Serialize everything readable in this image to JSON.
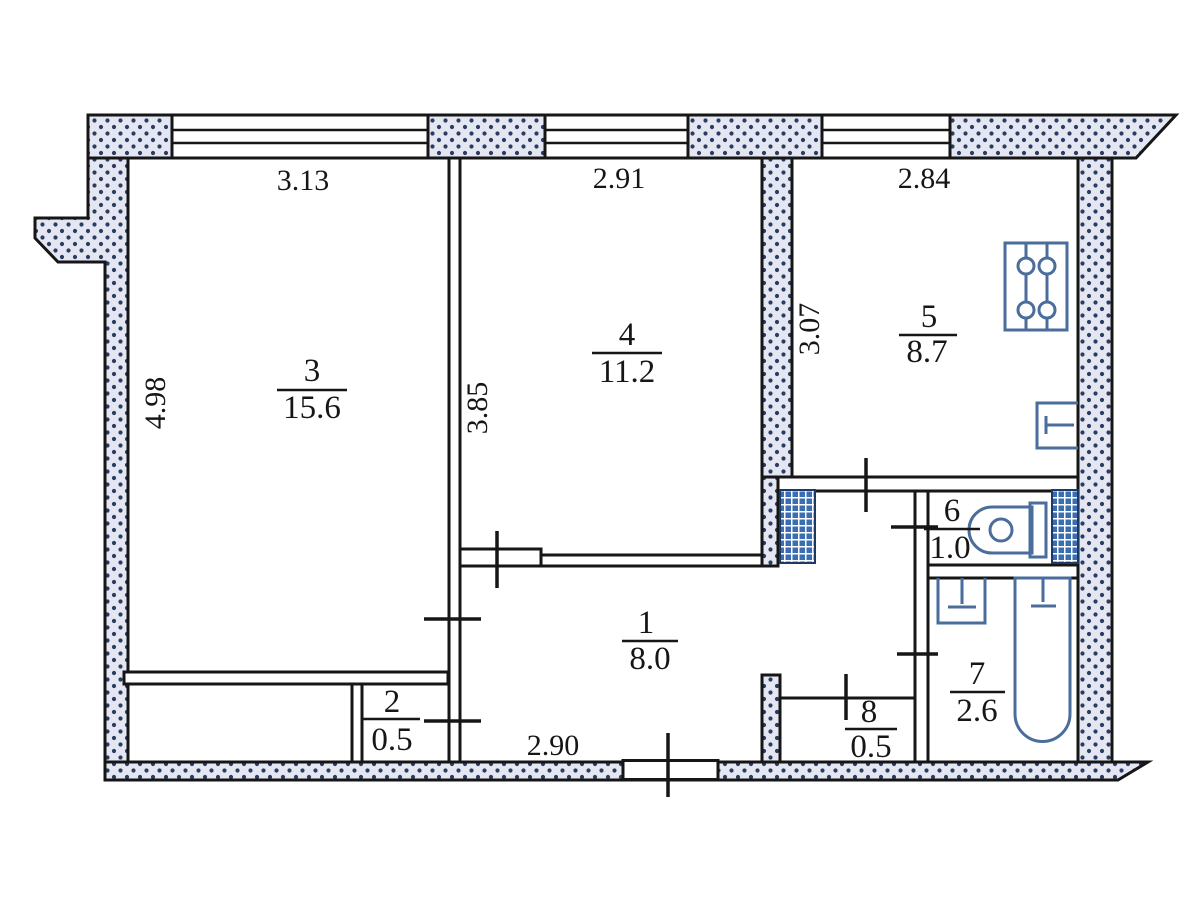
{
  "plan": {
    "type": "apartment-floor-plan",
    "rooms": [
      {
        "number": "3",
        "area": "15.6"
      },
      {
        "number": "4",
        "area": "11.2"
      },
      {
        "number": "5",
        "area": "8.7"
      },
      {
        "number": "1",
        "area": "8.0"
      },
      {
        "number": "2",
        "area": "0.5"
      },
      {
        "number": "6",
        "area": "1.0"
      },
      {
        "number": "7",
        "area": "2.6"
      },
      {
        "number": "8",
        "area": "0.5"
      }
    ],
    "dimensions": {
      "window_left": "3.13",
      "window_middle": "2.91",
      "window_right": "2.84",
      "left_wall": "4.98",
      "room4_depth": "3.85",
      "room5_depth": "3.07",
      "hall_width": "2.90"
    },
    "fixtures": [
      "stove",
      "kitchen-sink",
      "toilet",
      "washbasin",
      "bathtub"
    ],
    "colors": {
      "line": "#161616",
      "wall_fill": "#e4e7f2",
      "wall_dot": "#2b3c62",
      "fixture_outline": "#4a6d9b",
      "vent_blue": "#3a6db2"
    }
  }
}
